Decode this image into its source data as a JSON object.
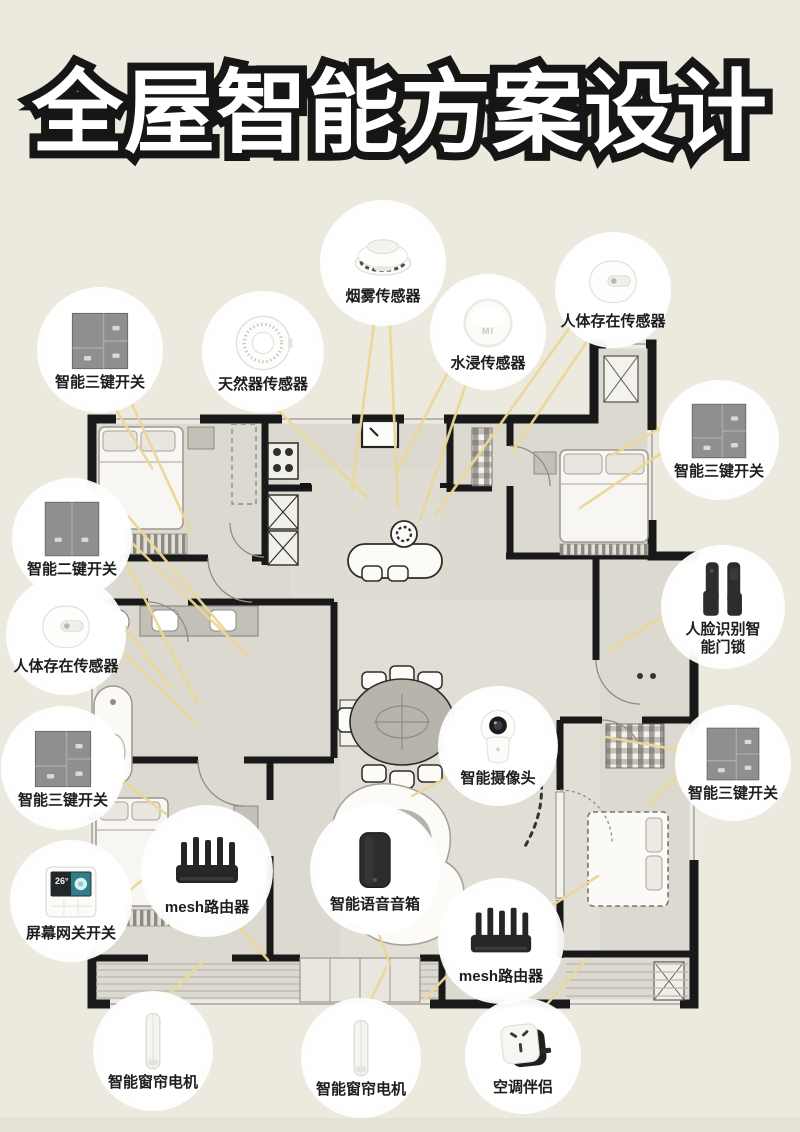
{
  "page": {
    "title": "全屋智能方案设计"
  },
  "colors": {
    "background": "#ece9df",
    "floor": "#dcd9d0",
    "wall": "#191919",
    "connector_line": "#ecd795",
    "label_text": "#1d1d1d",
    "switch_gray": "#8f8f8f",
    "device_dark": "#262626",
    "screen_teal": "#3d9aa1",
    "footer_strip": "#e5e1d6"
  },
  "callouts": [
    {
      "label": "智能三键开关",
      "device": "switch3-icon"
    },
    {
      "label": "天然器传感器",
      "device": "gas-sensor-icon"
    },
    {
      "label": "烟雾传感器",
      "device": "smoke-sensor-icon"
    },
    {
      "label": "水浸传感器",
      "device": "water-sensor-icon",
      "device_text": "MI"
    },
    {
      "label": "人体存在传感器",
      "device": "presence-sensor-icon"
    },
    {
      "label": "智能三键开关",
      "device": "switch3-icon"
    },
    {
      "label": "人脸识别智能门锁",
      "device": "door-lock-icon"
    },
    {
      "label": "智能三键开关",
      "device": "switch3-icon"
    },
    {
      "label": "智能二键开关",
      "device": "switch2-icon"
    },
    {
      "label": "人体存在传感器",
      "device": "presence-sensor-icon"
    },
    {
      "label": "智能三键开关",
      "device": "switch3-icon"
    },
    {
      "label": "屏幕网关开关",
      "device": "screen-gateway-icon",
      "screen_temp": "26°"
    },
    {
      "label": "mesh路由器",
      "device": "router-icon"
    },
    {
      "label": "智能语音音箱",
      "device": "speaker-icon"
    },
    {
      "label": "智能摄像头",
      "device": "camera-icon"
    },
    {
      "label": "mesh路由器",
      "device": "router-icon"
    },
    {
      "label": "智能窗帘电机",
      "device": "curtain-motor-icon"
    },
    {
      "label": "智能窗帘电机",
      "device": "curtain-motor-icon"
    },
    {
      "label": "空调伴侣",
      "device": "ac-companion-icon"
    }
  ]
}
